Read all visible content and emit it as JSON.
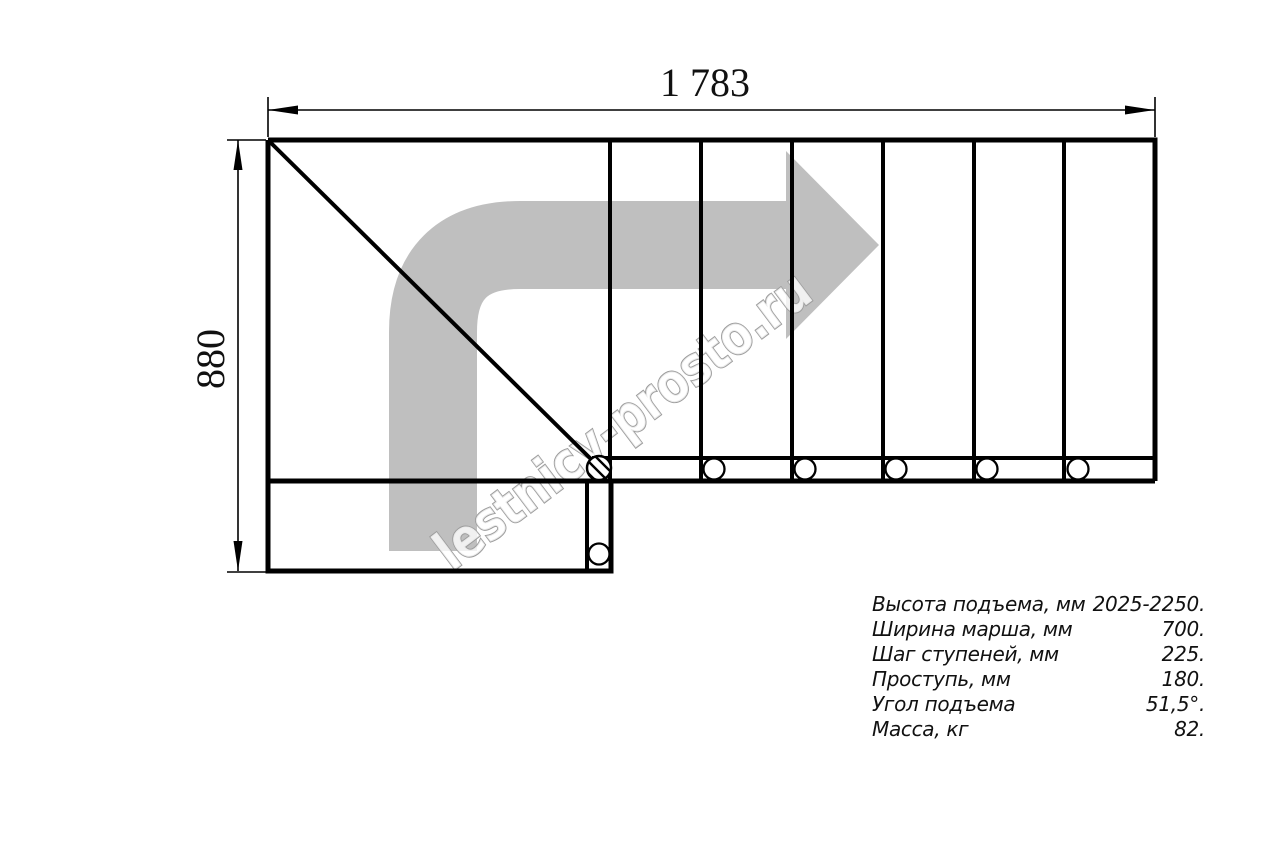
{
  "drawing": {
    "dim_width_label": "1 783",
    "dim_height_label": "880",
    "watermark": "lestnicy-prosto.ru",
    "colors": {
      "line": "#000000",
      "arrow_gray": "#bfbfbf",
      "watermark_gray": "#9c9c9c"
    }
  },
  "specs": {
    "rows": [
      {
        "label": "Высота подъема, мм",
        "value": "2025-2250."
      },
      {
        "label": "Ширина марша, мм",
        "value": "700."
      },
      {
        "label": "Шаг ступеней, мм",
        "value": "225."
      },
      {
        "label": "Проступь, мм",
        "value": "180."
      },
      {
        "label": "Угол подъема",
        "value": "51,5°."
      },
      {
        "label": "Масса, кг",
        "value": "82."
      }
    ]
  }
}
